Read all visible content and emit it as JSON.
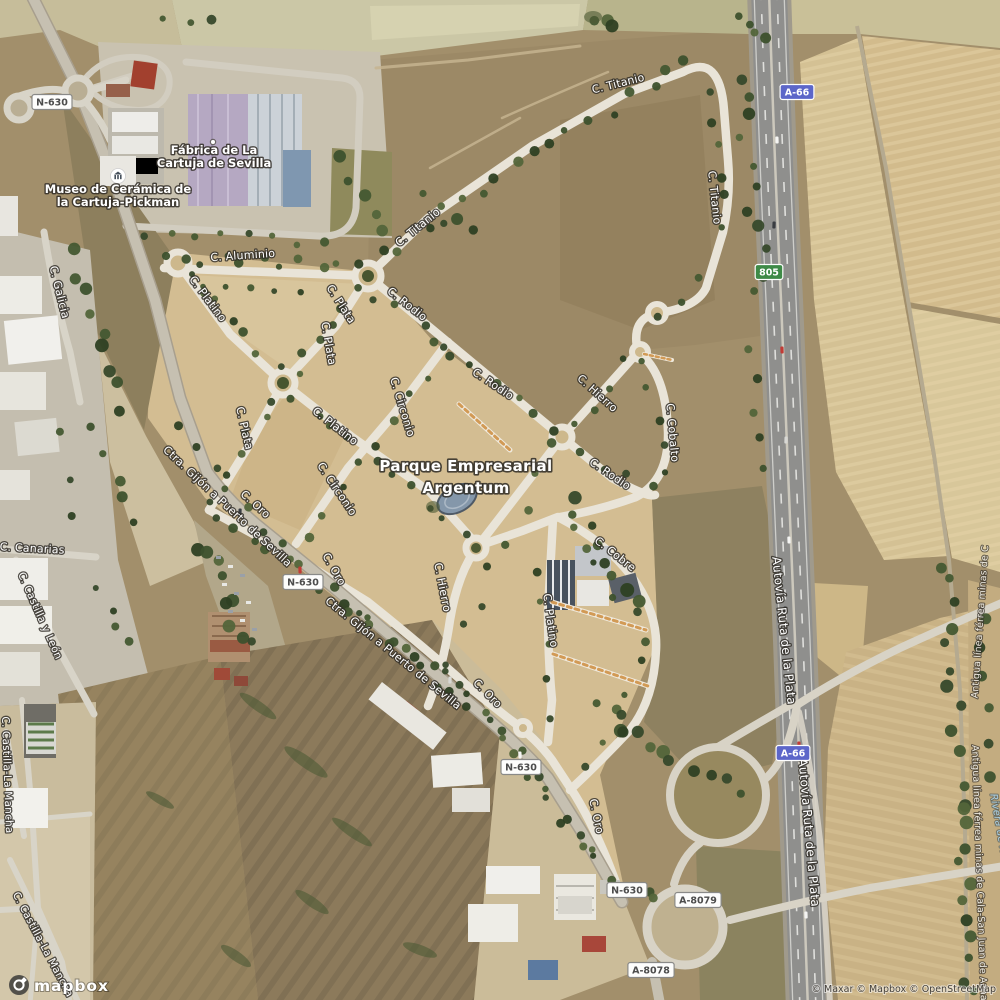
{
  "map": {
    "area_label": {
      "lines": [
        "Parque Empresarial",
        "Argentum"
      ],
      "x": 466,
      "y": 471,
      "line_height": 22
    },
    "poi_labels": [
      {
        "name": "museo-ceramica-label",
        "icon": "museum-icon",
        "ix": 118,
        "iy": 176,
        "x": 118,
        "y": 193,
        "lines": [
          "Museo de Cerámica de",
          "la Cartuja-Pickman"
        ]
      },
      {
        "name": "fabrica-cartuja-label",
        "icon": "poi-dot-icon",
        "ix": 213,
        "iy": 142,
        "x": 214,
        "y": 154,
        "lines": [
          "Fábrica de La",
          "Cartuja de Sevilla"
        ]
      }
    ],
    "street_labels": [
      {
        "text": "C. Aluminio",
        "x": 243,
        "y": 259,
        "r": -4,
        "s": 11
      },
      {
        "text": "C. Titanio",
        "x": 420,
        "y": 230,
        "r": -39,
        "s": 11
      },
      {
        "text": "C. Titanio",
        "x": 619,
        "y": 87,
        "r": -14,
        "s": 11
      },
      {
        "text": "C. Titanio",
        "x": 711,
        "y": 198,
        "r": 84,
        "s": 11
      },
      {
        "text": "C. Platino",
        "x": 205,
        "y": 301,
        "r": 53,
        "s": 11
      },
      {
        "text": "C. Plata",
        "x": 338,
        "y": 306,
        "r": 57,
        "s": 11
      },
      {
        "text": "C. Plata",
        "x": 325,
        "y": 344,
        "r": 80,
        "s": 11
      },
      {
        "text": "C. Rodio",
        "x": 405,
        "y": 307,
        "r": 38,
        "s": 11
      },
      {
        "text": "C. Rodio",
        "x": 491,
        "y": 387,
        "r": 34,
        "s": 11
      },
      {
        "text": "C. Rodio",
        "x": 608,
        "y": 477,
        "r": 34,
        "s": 11
      },
      {
        "text": "C. Hierro",
        "x": 595,
        "y": 396,
        "r": 42,
        "s": 11
      },
      {
        "text": "C. Cobalto",
        "x": 669,
        "y": 433,
        "r": 85,
        "s": 11
      },
      {
        "text": "C. Circonio",
        "x": 399,
        "y": 408,
        "r": 73,
        "s": 11
      },
      {
        "text": "C. Circonio",
        "x": 334,
        "y": 491,
        "r": 56,
        "s": 11
      },
      {
        "text": "C. Platino",
        "x": 333,
        "y": 429,
        "r": 38,
        "s": 11
      },
      {
        "text": "C. Plata",
        "x": 241,
        "y": 429,
        "r": 77,
        "s": 11
      },
      {
        "text": "C. Hierro",
        "x": 439,
        "y": 588,
        "r": 79,
        "s": 11
      },
      {
        "text": "C. Platino",
        "x": 547,
        "y": 621,
        "r": 82,
        "s": 11
      },
      {
        "text": "C. Cobre",
        "x": 613,
        "y": 557,
        "r": 38,
        "s": 11
      },
      {
        "text": "C. Oro",
        "x": 253,
        "y": 507,
        "r": 42,
        "s": 11
      },
      {
        "text": "C. Oro",
        "x": 331,
        "y": 571,
        "r": 60,
        "s": 11
      },
      {
        "text": "C. Oro",
        "x": 485,
        "y": 696,
        "r": 45,
        "s": 11
      },
      {
        "text": "C. Oro",
        "x": 593,
        "y": 817,
        "r": 78,
        "s": 11
      },
      {
        "text": "C. Galicia",
        "x": 56,
        "y": 293,
        "r": 76,
        "s": 11
      },
      {
        "text": "C. Canarias",
        "x": 32,
        "y": 552,
        "r": 3,
        "s": 11
      },
      {
        "text": "C. Castilla y León",
        "x": 37,
        "y": 617,
        "r": 66,
        "s": 10.5
      },
      {
        "text": "C. Castilla-La Mancha",
        "x": 4,
        "y": 775,
        "r": 88,
        "s": 10.5
      },
      {
        "text": "C. Castilla-La Mancha",
        "x": 40,
        "y": 946,
        "r": 62,
        "s": 10.5
      },
      {
        "text": "Ctra. Gijón a Puerto de Sevilla",
        "x": 225,
        "y": 509,
        "r": 43,
        "s": 11
      },
      {
        "text": "Ctra. Gijón a Puerto de Sevilla",
        "x": 391,
        "y": 656,
        "r": 39,
        "s": 11
      },
      {
        "text": "Autovía Ruta de la Plata",
        "x": 780,
        "y": 631,
        "r": 84,
        "s": 12
      },
      {
        "text": "Autovía Ruta de la Plata",
        "x": 805,
        "y": 833,
        "r": 85,
        "s": 12
      },
      {
        "text": "Antigua línea férrea minas de C",
        "x": 983,
        "y": 622,
        "r": -86,
        "s": 9.5,
        "cls": "rail"
      },
      {
        "text": "Antigua línea férrea minas de Cala-San Juan de Aznalfarache",
        "x": 972,
        "y": 745,
        "r": 88,
        "s": 9.5,
        "cls": "rail",
        "anchor": "start"
      },
      {
        "text": "Rivera de Huelva",
        "x": 998,
        "y": 838,
        "r": 80,
        "s": 10,
        "cls": "water"
      }
    ],
    "shields": [
      {
        "text": "N-630",
        "x": 52,
        "y": 102,
        "type": "national"
      },
      {
        "text": "N-630",
        "x": 303,
        "y": 582,
        "type": "national"
      },
      {
        "text": "N-630",
        "x": 521,
        "y": 767,
        "type": "national"
      },
      {
        "text": "N-630",
        "x": 627,
        "y": 890,
        "type": "national"
      },
      {
        "text": "A-66",
        "x": 797,
        "y": 92,
        "type": "motorway"
      },
      {
        "text": "A-66",
        "x": 793,
        "y": 753,
        "type": "motorway"
      },
      {
        "text": "805",
        "x": 769,
        "y": 272,
        "type": "regional"
      },
      {
        "text": "A-8079",
        "x": 698,
        "y": 900,
        "type": "national"
      },
      {
        "text": "A-8078",
        "x": 651,
        "y": 970,
        "type": "national"
      }
    ],
    "shield_styles": {
      "national": {
        "bg": "#fdfdfc",
        "border": "#8a8a88",
        "text": "#4c4c4c"
      },
      "motorway": {
        "bg": "#5c66c9",
        "border": "#ffffff",
        "text": "#ffffff"
      },
      "regional": {
        "bg": "#3e8a47",
        "border": "#ffffff",
        "text": "#ffffff"
      }
    }
  },
  "branding": {
    "logo_text": "mapbox",
    "logo_icon": "mapbox-logo-icon",
    "attribution": "© Maxar © Mapbox © OpenStreetMap"
  }
}
